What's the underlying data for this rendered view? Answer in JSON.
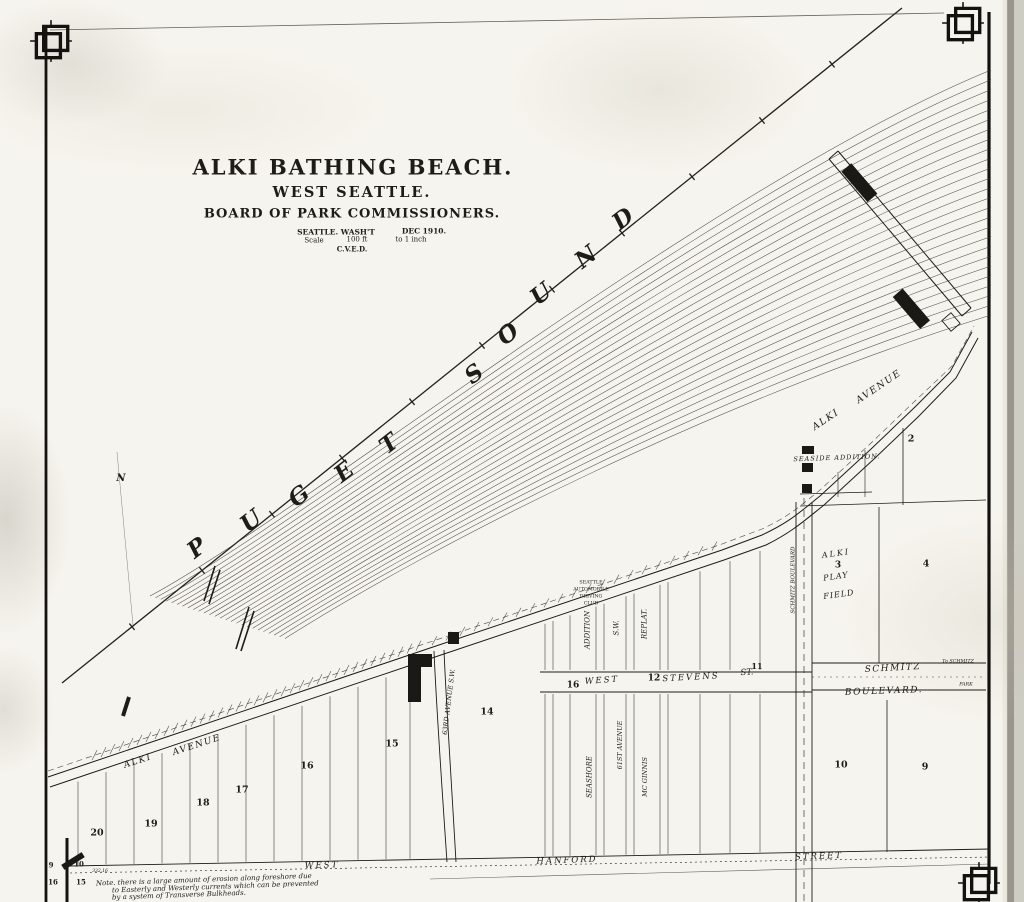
{
  "map": {
    "kind": "scanned plat / survey map",
    "water_name": "PUGET SOUND",
    "ink_color": "#1e1c17",
    "paper_color": "#f6f4ee"
  },
  "title_block": {
    "title": "ALKI BATHING BEACH.",
    "subtitle": "WEST SEATTLE.",
    "organization": "BOARD OF PARK COMMISSIONERS.",
    "place": "SEATTLE. WASH'T",
    "date": "DEC 1910.",
    "scale_label": "Scale",
    "scale_value": "100 ft",
    "scale_unit": "to 1 inch",
    "initials": "C.V.E.D."
  },
  "note": {
    "line1": "Note.  there is a large amount of erosion along foreshore due",
    "line2": "to Easterly and Westerly currents which can be prevented",
    "line3": "by a system of Transverse Bulkheads."
  },
  "labels": [
    {
      "n": "map-title",
      "t": "ALKI BATHING BEACH.",
      "x": 353,
      "y": 167,
      "s": 21,
      "w": 700,
      "ls": 2
    },
    {
      "n": "map-subtitle",
      "t": "WEST SEATTLE.",
      "x": 352,
      "y": 193,
      "s": 14.5,
      "w": 700,
      "ls": 2
    },
    {
      "n": "map-organization",
      "t": "BOARD OF PARK COMMISSIONERS.",
      "x": 352,
      "y": 214,
      "s": 13,
      "w": 700,
      "ls": 1
    },
    {
      "n": "map-place",
      "t": "SEATTLE. WASH'T",
      "x": 336,
      "y": 232,
      "s": 7.5,
      "w": 600
    },
    {
      "n": "map-date",
      "t": "DEC 1910.",
      "x": 424,
      "y": 231,
      "s": 7.5,
      "w": 600
    },
    {
      "n": "scale-label",
      "t": "Scale",
      "x": 314,
      "y": 241,
      "s": 7
    },
    {
      "n": "scale-value",
      "t": "100 ft",
      "x": 357,
      "y": 240,
      "s": 7
    },
    {
      "n": "scale-unit",
      "t": "to 1 inch",
      "x": 411,
      "y": 240,
      "s": 7
    },
    {
      "n": "initials",
      "t": "C.V.E.D.",
      "x": 352,
      "y": 249,
      "s": 7,
      "w": 600
    },
    {
      "n": "water-letter-p",
      "t": "P",
      "x": 197,
      "y": 548,
      "s": 23,
      "i": 1,
      "w": 600,
      "r": -38
    },
    {
      "n": "water-letter-u1",
      "t": "U",
      "x": 251,
      "y": 521,
      "s": 23,
      "i": 1,
      "w": 600,
      "r": -38
    },
    {
      "n": "water-letter-g",
      "t": "G",
      "x": 299,
      "y": 496,
      "s": 23,
      "i": 1,
      "w": 600,
      "r": -38
    },
    {
      "n": "water-letter-e",
      "t": "E",
      "x": 344,
      "y": 472,
      "s": 23,
      "i": 1,
      "w": 600,
      "r": -38
    },
    {
      "n": "water-letter-t",
      "t": "T",
      "x": 389,
      "y": 444,
      "s": 23,
      "i": 1,
      "w": 600,
      "r": -38
    },
    {
      "n": "water-letter-s",
      "t": "S",
      "x": 474,
      "y": 374,
      "s": 23,
      "i": 1,
      "w": 600,
      "r": -38
    },
    {
      "n": "water-letter-o",
      "t": "O",
      "x": 508,
      "y": 334,
      "s": 23,
      "i": 1,
      "w": 600,
      "r": -38
    },
    {
      "n": "water-letter-u2",
      "t": "U",
      "x": 541,
      "y": 294,
      "s": 23,
      "i": 1,
      "w": 600,
      "r": -38
    },
    {
      "n": "water-letter-n",
      "t": "N",
      "x": 586,
      "y": 257,
      "s": 23,
      "i": 1,
      "w": 600,
      "r": -38
    },
    {
      "n": "water-letter-d",
      "t": "D",
      "x": 623,
      "y": 219,
      "s": 23,
      "i": 1,
      "w": 600,
      "r": -38
    },
    {
      "n": "street-alki-avenue-west-1",
      "t": "ALKI",
      "x": 138,
      "y": 762,
      "s": 9,
      "i": 1,
      "r": -18,
      "ls": 1.5
    },
    {
      "n": "street-alki-avenue-west-2",
      "t": "AVENUE",
      "x": 197,
      "y": 746,
      "s": 9,
      "i": 1,
      "r": -18,
      "ls": 1.5
    },
    {
      "n": "street-alki-avenue-east-1",
      "t": "ALKI",
      "x": 826,
      "y": 420,
      "s": 9.5,
      "i": 1,
      "r": -34,
      "ls": 1.5
    },
    {
      "n": "street-alki-avenue-east-2",
      "t": "AVENUE",
      "x": 879,
      "y": 387,
      "s": 9.5,
      "i": 1,
      "r": -34,
      "ls": 1.5
    },
    {
      "n": "plat-seaside-addition",
      "t": "SEASIDE ADDITION.",
      "x": 837,
      "y": 458,
      "s": 6.5,
      "i": 1,
      "r": -2,
      "ls": 1
    },
    {
      "n": "seattle-automobile-driving-club-1",
      "t": "SEATTLE",
      "x": 591,
      "y": 584,
      "s": 4.8
    },
    {
      "n": "seattle-automobile-driving-club-2",
      "t": "AUTOMOBILE",
      "x": 591,
      "y": 591,
      "s": 4.8
    },
    {
      "n": "seattle-automobile-driving-club-3",
      "t": "DRIVING",
      "x": 591,
      "y": 598,
      "s": 4.8
    },
    {
      "n": "seattle-automobile-driving-club-4",
      "t": "CLUB",
      "x": 591,
      "y": 605,
      "s": 4.8
    },
    {
      "n": "plat-addition",
      "t": "ADDITION",
      "x": 588,
      "y": 630,
      "s": 7,
      "i": 1,
      "r": -90
    },
    {
      "n": "plat-sw",
      "t": "S.W.",
      "x": 617,
      "y": 628,
      "s": 7,
      "i": 1,
      "r": -90
    },
    {
      "n": "plat-replat",
      "t": "REPLAT.",
      "x": 645,
      "y": 624,
      "s": 7,
      "i": 1,
      "r": -90
    },
    {
      "n": "street-seashore",
      "t": "SEASHORE",
      "x": 590,
      "y": 777,
      "s": 7,
      "i": 1,
      "r": -90
    },
    {
      "n": "street-61st-avenue",
      "t": "61ST AVENUE",
      "x": 620,
      "y": 745,
      "s": 6.5,
      "i": 1,
      "r": -90
    },
    {
      "n": "plat-mc-ginnis",
      "t": "MC GINNIS",
      "x": 645,
      "y": 777,
      "s": 6.5,
      "i": 1,
      "r": -90
    },
    {
      "n": "street-63rd-avenue-sw",
      "t": "63RD AVENUE S.W.",
      "x": 449,
      "y": 702,
      "s": 6.5,
      "i": 1,
      "r": -83
    },
    {
      "n": "street-schmitz-boulevard-vertical",
      "t": "SCHMITZ BOULEVARD",
      "x": 794,
      "y": 580,
      "s": 5.5,
      "i": 1,
      "r": -90
    },
    {
      "n": "block-16-stevens",
      "t": "16",
      "x": 573,
      "y": 686,
      "s": 9,
      "w": 700
    },
    {
      "n": "street-west-stevens-1",
      "t": "WEST",
      "x": 602,
      "y": 681,
      "s": 8.5,
      "i": 1,
      "r": -4,
      "ls": 2
    },
    {
      "n": "block-12",
      "t": "12",
      "x": 654,
      "y": 679,
      "s": 9,
      "w": 700
    },
    {
      "n": "street-west-stevens-2",
      "t": "STEVENS",
      "x": 691,
      "y": 678,
      "s": 8.5,
      "i": 1,
      "r": -3,
      "ls": 2
    },
    {
      "n": "street-west-stevens-3",
      "t": "ST.",
      "x": 747,
      "y": 673,
      "s": 8.5,
      "i": 1,
      "r": -3
    },
    {
      "n": "block-11",
      "t": "11",
      "x": 757,
      "y": 666,
      "s": 8,
      "w": 700
    },
    {
      "n": "street-schmitz-1",
      "t": "SCHMITZ",
      "x": 893,
      "y": 669,
      "s": 9,
      "i": 1,
      "r": -3,
      "ls": 1.5
    },
    {
      "n": "street-schmitz-2",
      "t": "BOULEVARD.",
      "x": 884,
      "y": 692,
      "s": 9,
      "i": 1,
      "r": -2,
      "ls": 1.5
    },
    {
      "n": "to-schmitz-1",
      "t": "To SCHMITZ",
      "x": 958,
      "y": 663,
      "s": 4.8,
      "i": 1
    },
    {
      "n": "to-schmitz-2",
      "t": "PARK",
      "x": 966,
      "y": 686,
      "s": 4.8,
      "i": 1
    },
    {
      "n": "street-west-hanford-1",
      "t": "WEST",
      "x": 322,
      "y": 866,
      "s": 8.5,
      "i": 1,
      "r": -2,
      "ls": 2
    },
    {
      "n": "street-west-hanford-2",
      "t": "HANFORD",
      "x": 567,
      "y": 861,
      "s": 8.5,
      "i": 1,
      "r": -2,
      "ls": 2
    },
    {
      "n": "street-west-hanford-3",
      "t": "STREET",
      "x": 819,
      "y": 857,
      "s": 8.5,
      "i": 1,
      "r": -2,
      "ls": 2
    },
    {
      "n": "alki-play-field-1",
      "t": "ALKI",
      "x": 836,
      "y": 554,
      "s": 8,
      "i": 1,
      "r": -8,
      "ls": 2
    },
    {
      "n": "block-3",
      "t": "3",
      "x": 838,
      "y": 566,
      "s": 9,
      "w": 700
    },
    {
      "n": "alki-play-field-2",
      "t": "PLAY",
      "x": 836,
      "y": 577,
      "s": 8,
      "i": 1,
      "r": -8,
      "ls": 1
    },
    {
      "n": "alki-play-field-3",
      "t": "FIELD",
      "x": 839,
      "y": 595,
      "s": 8,
      "i": 1,
      "r": -8,
      "ls": 1
    },
    {
      "n": "block-20",
      "t": "20",
      "x": 97,
      "y": 833,
      "s": 9.5,
      "w": 700
    },
    {
      "n": "block-19",
      "t": "19",
      "x": 151,
      "y": 824,
      "s": 9.5,
      "w": 700
    },
    {
      "n": "block-18",
      "t": "18",
      "x": 203,
      "y": 803,
      "s": 9.5,
      "w": 700
    },
    {
      "n": "block-17",
      "t": "17",
      "x": 242,
      "y": 790,
      "s": 9.5,
      "w": 700
    },
    {
      "n": "block-16",
      "t": "16",
      "x": 307,
      "y": 766,
      "s": 9.5,
      "w": 700
    },
    {
      "n": "block-15",
      "t": "15",
      "x": 392,
      "y": 744,
      "s": 9.5,
      "w": 700
    },
    {
      "n": "block-14",
      "t": "14",
      "x": 487,
      "y": 712,
      "s": 9.5,
      "w": 700
    },
    {
      "n": "block-2",
      "t": "2",
      "x": 911,
      "y": 439,
      "s": 9.5,
      "w": 700
    },
    {
      "n": "block-4",
      "t": "4",
      "x": 926,
      "y": 564,
      "s": 9.5,
      "w": 700
    },
    {
      "n": "block-10",
      "t": "10",
      "x": 841,
      "y": 765,
      "s": 9.5,
      "w": 700
    },
    {
      "n": "block-9",
      "t": "9",
      "x": 925,
      "y": 767,
      "s": 9.5,
      "w": 700
    },
    {
      "n": "section-corner-9",
      "t": "9",
      "x": 51,
      "y": 865,
      "s": 7,
      "w": 700
    },
    {
      "n": "section-corner-10",
      "t": "10",
      "x": 79,
      "y": 864,
      "s": 7,
      "w": 700
    },
    {
      "n": "section-corner-16",
      "t": "16",
      "x": 53,
      "y": 882,
      "s": 7,
      "w": 700
    },
    {
      "n": "section-corner-15",
      "t": "15",
      "x": 81,
      "y": 882,
      "s": 7,
      "w": 700
    },
    {
      "n": "dimension-332-16",
      "t": "332.16",
      "x": 100,
      "y": 872,
      "s": 4.5,
      "i": 1
    },
    {
      "n": "north-mark",
      "t": "N",
      "x": 121,
      "y": 479,
      "s": 10,
      "i": 1,
      "w": 600
    },
    {
      "n": "note-line-1",
      "t": "Note.  there is a large amount of erosion along foreshore due",
      "x": 96,
      "y": 884,
      "s": 7,
      "i": 1,
      "r": -2,
      "a": "s"
    },
    {
      "n": "note-line-2",
      "t": "to Easterly and Westerly currents which can be prevented",
      "x": 112,
      "y": 891,
      "s": 7,
      "i": 1,
      "r": -2,
      "a": "s"
    },
    {
      "n": "note-line-3",
      "t": "by a system of Transverse Bulkheads.",
      "x": 112,
      "y": 898,
      "s": 7,
      "i": 1,
      "r": -2,
      "a": "s"
    }
  ]
}
